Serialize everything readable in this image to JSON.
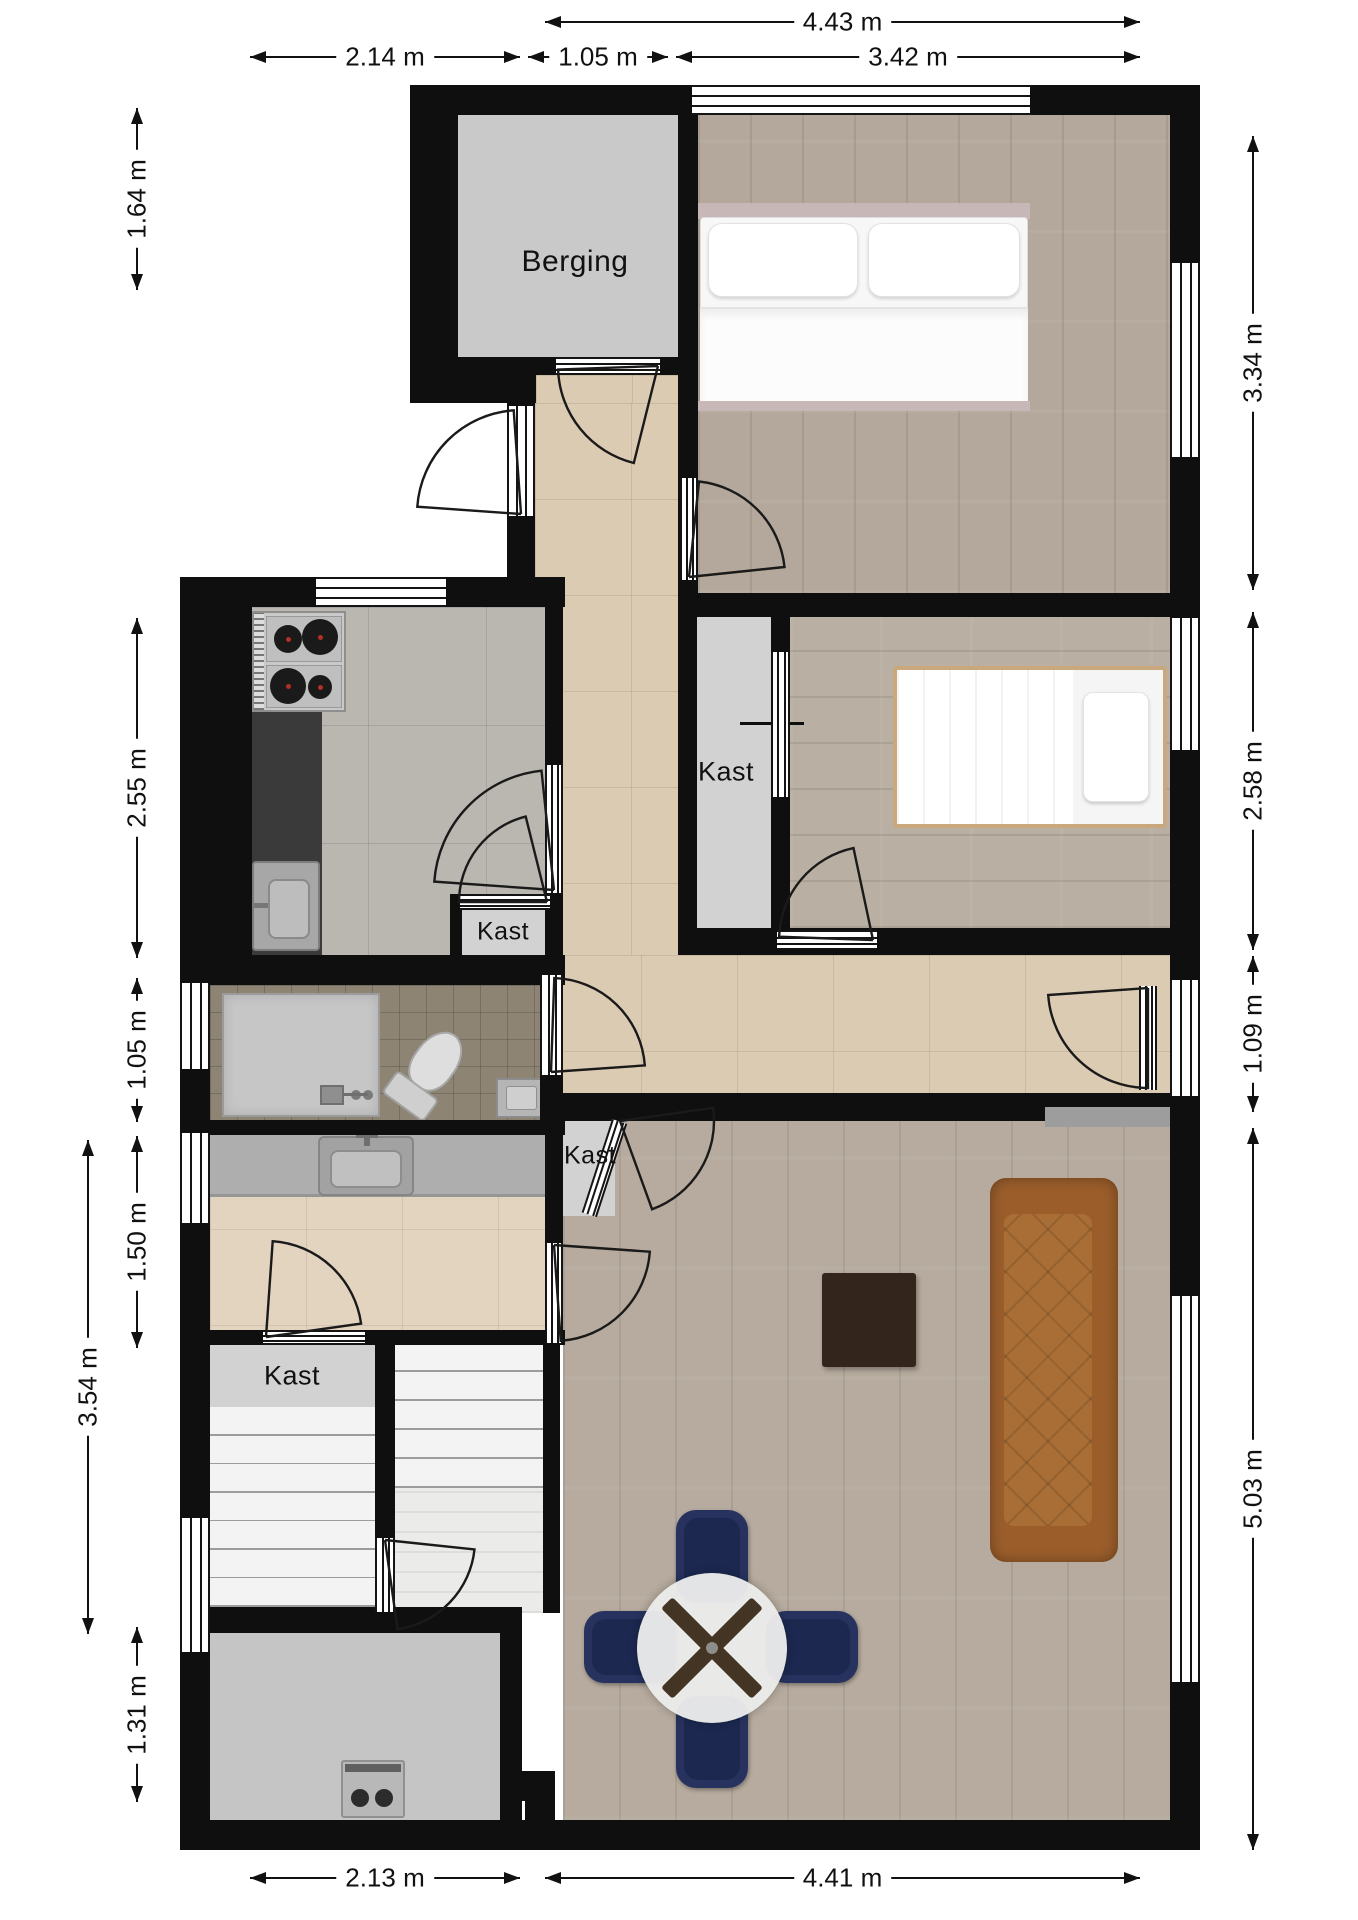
{
  "meta": {
    "type": "floor-plan",
    "language": "nl"
  },
  "colors": {
    "wall": "#0f0f0f",
    "background": "#ffffff",
    "dimension": "#111111",
    "wood_floor": "#b3a89b",
    "hall_tile": "#dccbb3",
    "kitchen_tile": "#bab7b1",
    "toilet_tile": "#8d8474",
    "closet_grey": "#d2d2d2",
    "sofa_leather": "#9b5e2b",
    "chair_navy": "#27335e",
    "coffee_table": "#33251c",
    "counter_dark": "#3a3a3a"
  },
  "room_labels": [
    {
      "text": "Berging",
      "x": 575,
      "y": 262,
      "size": 30
    },
    {
      "text": "Kast",
      "x": 726,
      "y": 772,
      "size": 27
    },
    {
      "text": "Kast",
      "x": 503,
      "y": 932,
      "size": 25
    },
    {
      "text": "Kast",
      "x": 590,
      "y": 1156,
      "size": 25
    },
    {
      "text": "Kast",
      "x": 292,
      "y": 1376,
      "size": 27
    }
  ],
  "dimensions": [
    {
      "label": "4.43 m",
      "dir": "h",
      "a": 545,
      "b": 1140,
      "at": 22
    },
    {
      "label": "2.14 m",
      "dir": "h",
      "a": 250,
      "b": 520,
      "at": 57
    },
    {
      "label": "1.05 m",
      "dir": "h",
      "a": 528,
      "b": 668,
      "at": 57
    },
    {
      "label": "3.42 m",
      "dir": "h",
      "a": 676,
      "b": 1140,
      "at": 57
    },
    {
      "label": "1.64 m",
      "dir": "v",
      "a": 108,
      "b": 290,
      "at": 137
    },
    {
      "label": "2.55 m",
      "dir": "v",
      "a": 618,
      "b": 958,
      "at": 137
    },
    {
      "label": "1.05 m",
      "dir": "v",
      "a": 978,
      "b": 1122,
      "at": 137
    },
    {
      "label": "1.50 m",
      "dir": "v",
      "a": 1136,
      "b": 1348,
      "at": 137
    },
    {
      "label": "3.54 m",
      "dir": "v",
      "a": 1140,
      "b": 1634,
      "at": 88
    },
    {
      "label": "1.31 m",
      "dir": "v",
      "a": 1627,
      "b": 1802,
      "at": 137
    },
    {
      "label": "3.34 m",
      "dir": "v",
      "a": 136,
      "b": 590,
      "at": 1253
    },
    {
      "label": "2.58 m",
      "dir": "v",
      "a": 612,
      "b": 950,
      "at": 1253
    },
    {
      "label": "1.09 m",
      "dir": "v",
      "a": 956,
      "b": 1112,
      "at": 1253
    },
    {
      "label": "5.03 m",
      "dir": "v",
      "a": 1128,
      "b": 1850,
      "at": 1253
    },
    {
      "label": "2.13 m",
      "dir": "h",
      "a": 250,
      "b": 520,
      "at": 1878
    },
    {
      "label": "4.41 m",
      "dir": "h",
      "a": 545,
      "b": 1140,
      "at": 1878
    }
  ],
  "plan": {
    "floors": [
      {
        "name": "berging",
        "r": [
          457,
          115,
          221,
          242
        ],
        "f": "grey"
      },
      {
        "name": "hall-upper",
        "r": [
          536,
          375,
          142,
          28
        ],
        "f": "hall"
      },
      {
        "name": "hall",
        "r": [
          535,
          403,
          143,
          552
        ],
        "f": "hall"
      },
      {
        "name": "bedroom-1",
        "r": [
          698,
          115,
          472,
          478
        ],
        "f": "wood-v"
      },
      {
        "name": "closet-bedroom-2",
        "r": [
          697,
          617,
          74,
          323
        ],
        "f": "grey-light"
      },
      {
        "name": "bedroom-2",
        "r": [
          790,
          617,
          380,
          311
        ],
        "f": "wood-h"
      },
      {
        "name": "kitchen",
        "r": [
          250,
          607,
          295,
          348
        ],
        "f": "kitchen"
      },
      {
        "name": "closet-kitchen",
        "r": [
          462,
          908,
          83,
          47
        ],
        "f": "grey-light"
      },
      {
        "name": "toilet",
        "r": [
          210,
          985,
          330,
          135
        ],
        "f": "toilet"
      },
      {
        "name": "washroom",
        "r": [
          210,
          1133,
          335,
          197
        ],
        "f": "wash"
      },
      {
        "name": "corridor",
        "r": [
          545,
          955,
          625,
          138
        ],
        "f": "hall"
      },
      {
        "name": "living-room",
        "r": [
          563,
          1121,
          607,
          699
        ],
        "f": "wood-l"
      },
      {
        "name": "closet-corridor",
        "r": [
          563,
          1121,
          52,
          95
        ],
        "f": "grey-light"
      },
      {
        "name": "closet-stairs",
        "r": [
          210,
          1343,
          165,
          64
        ],
        "f": "grey-light"
      },
      {
        "name": "stairs-left-base",
        "r": [
          210,
          1407,
          165,
          200
        ],
        "f": "grey-light"
      },
      {
        "name": "stairs-right-base",
        "r": [
          395,
          1343,
          148,
          145
        ],
        "f": "white"
      },
      {
        "name": "stair-landing",
        "r": [
          395,
          1488,
          148,
          125
        ],
        "f": "planks"
      },
      {
        "name": "entrance",
        "r": [
          210,
          1633,
          290,
          187
        ],
        "f": "grey-dark"
      },
      {
        "name": "niche-shelf",
        "r": [
          1045,
          1107,
          125,
          20
        ],
        "f": "grey-mid"
      }
    ],
    "walls": [
      {
        "n": "top",
        "r": [
          410,
          85,
          790,
          30
        ]
      },
      {
        "n": "right",
        "r": [
          1170,
          85,
          30,
          1765
        ]
      },
      {
        "n": "left-top",
        "r": [
          410,
          85,
          48,
          292
        ]
      },
      {
        "n": "facade-step",
        "r": [
          410,
          375,
          126,
          28
        ]
      },
      {
        "n": "hall-west",
        "r": [
          507,
          403,
          28,
          174
        ]
      },
      {
        "n": "kitchen-top",
        "r": [
          180,
          577,
          385,
          30
        ]
      },
      {
        "n": "kitchen-west",
        "r": [
          180,
          577,
          72,
          380
        ]
      },
      {
        "n": "left-lower",
        "r": [
          180,
          955,
          30,
          895
        ]
      },
      {
        "n": "bottom",
        "r": [
          180,
          1820,
          1020,
          30
        ]
      },
      {
        "n": "berging-east",
        "r": [
          678,
          115,
          20,
          262
        ]
      },
      {
        "n": "berging-south",
        "r": [
          457,
          357,
          241,
          18
        ]
      },
      {
        "n": "bed1-west",
        "r": [
          678,
          377,
          20,
          216
        ]
      },
      {
        "n": "bed1-south",
        "r": [
          678,
          593,
          522,
          24
        ]
      },
      {
        "n": "closet2-divider",
        "r": [
          771,
          617,
          19,
          323
        ]
      },
      {
        "n": "corridor-east",
        "r": [
          678,
          617,
          19,
          338
        ]
      },
      {
        "n": "bed2-south",
        "r": [
          678,
          928,
          522,
          27
        ]
      },
      {
        "n": "living-top",
        "r": [
          545,
          1093,
          500,
          28
        ]
      },
      {
        "n": "niche-top",
        "r": [
          1045,
          1093,
          125,
          14
        ]
      },
      {
        "n": "toilet-east",
        "r": [
          540,
          955,
          23,
          180
        ]
      },
      {
        "n": "kitchen-east",
        "r": [
          545,
          577,
          18,
          380
        ]
      },
      {
        "n": "kitchen-south",
        "r": [
          180,
          955,
          385,
          30
        ]
      },
      {
        "n": "toilet-south",
        "r": [
          180,
          1120,
          385,
          15
        ]
      },
      {
        "n": "closet-kitchen-west",
        "r": [
          450,
          894,
          12,
          61
        ]
      },
      {
        "n": "wash-south",
        "r": [
          180,
          1330,
          385,
          15
        ]
      },
      {
        "n": "stairs-divider",
        "r": [
          375,
          1343,
          20,
          290
        ]
      },
      {
        "n": "stairs-south",
        "r": [
          210,
          1607,
          167,
          26
        ]
      },
      {
        "n": "landing-east",
        "r": [
          543,
          1343,
          17,
          270
        ]
      },
      {
        "n": "landing-south",
        "r": [
          375,
          1607,
          147,
          26
        ]
      },
      {
        "n": "entrance-east",
        "r": [
          500,
          1613,
          22,
          207
        ]
      },
      {
        "n": "living-west-upper",
        "r": [
          545,
          1121,
          18,
          122
        ]
      },
      {
        "n": "chimney-a",
        "r": [
          500,
          1771,
          55,
          30
        ]
      },
      {
        "n": "chimney-b",
        "r": [
          525,
          1799,
          30,
          23
        ]
      },
      {
        "n": "window-divider-bed1",
        "r": [
          851,
          87,
          4,
          26
        ]
      },
      {
        "n": "sliding-door-tick",
        "r": [
          740,
          722,
          64,
          3
        ]
      }
    ],
    "windows": [
      {
        "r": [
          692,
          85,
          338,
          30
        ],
        "o": "h"
      },
      {
        "r": [
          316,
          577,
          130,
          30
        ],
        "o": "h"
      },
      {
        "r": [
          180,
          983,
          30,
          86
        ],
        "o": "v"
      },
      {
        "r": [
          180,
          1133,
          30,
          90
        ],
        "o": "v"
      },
      {
        "r": [
          180,
          1518,
          30,
          134
        ],
        "o": "v"
      },
      {
        "r": [
          1170,
          263,
          30,
          194
        ],
        "o": "v"
      },
      {
        "r": [
          1170,
          618,
          30,
          132
        ],
        "o": "v"
      },
      {
        "r": [
          1170,
          980,
          30,
          116
        ],
        "o": "v"
      },
      {
        "r": [
          1170,
          1296,
          30,
          386
        ],
        "o": "v"
      }
    ],
    "doors": [
      {
        "id": "berging-door",
        "panel": [
          556,
          357,
          104,
          18
        ],
        "hinge": [
          658,
          366
        ],
        "r": 100,
        "a1": 178,
        "a2": 104
      },
      {
        "id": "entrance-door",
        "panel": [
          507,
          406,
          28,
          110
        ],
        "hinge": [
          521,
          514
        ],
        "r": 104,
        "a1": 184,
        "a2": 266
      },
      {
        "id": "kitchen-closet-door",
        "panel": [
          460,
          894,
          90,
          16
        ],
        "hinge": [
          547,
          902
        ],
        "r": 88,
        "a1": 180,
        "a2": 256
      },
      {
        "id": "kitchen-door",
        "panel": [
          545,
          765,
          18,
          128
        ],
        "hinge": [
          554,
          890
        ],
        "r": 120,
        "a1": 184,
        "a2": 264
      },
      {
        "id": "bedroom1-door",
        "panel": [
          680,
          478,
          18,
          102
        ],
        "hinge": [
          689,
          577
        ],
        "r": 96,
        "a1": 276,
        "a2": 354
      },
      {
        "id": "bedroom2-door",
        "panel": [
          777,
          930,
          100,
          20
        ],
        "hinge": [
          873,
          940
        ],
        "r": 94,
        "a1": 182,
        "a2": 258
      },
      {
        "id": "toilet-door",
        "panel": [
          540,
          975,
          23,
          100
        ],
        "hinge": [
          551,
          1072
        ],
        "r": 94,
        "a1": 272,
        "a2": 356
      },
      {
        "id": "living-door",
        "panel": [
          1139,
          986,
          18,
          104
        ],
        "hinge": [
          1148,
          988
        ],
        "r": 100,
        "a1": 90,
        "a2": 176
      },
      {
        "id": "corridor-closet-door",
        "panel": [
          612,
          1119,
          16,
          98
        ],
        "rot": 18,
        "hinge": [
          620,
          1121
        ],
        "r": 94,
        "a1": -8,
        "a2": 70
      },
      {
        "id": "washroom-living-door",
        "panel": [
          545,
          1243,
          18,
          100
        ],
        "hinge": [
          554,
          1245
        ],
        "r": 96,
        "a1": 4,
        "a2": 86
      },
      {
        "id": "stairs-landing-door",
        "panel": [
          375,
          1538,
          20,
          74
        ],
        "hinge": [
          385,
          1540
        ],
        "r": 90,
        "a1": 6,
        "a2": 82
      },
      {
        "id": "stairs-closet-door",
        "panel": [
          263,
          1330,
          102,
          15
        ],
        "hinge": [
          266,
          1337
        ],
        "r": 96,
        "a1": 274,
        "a2": 352
      },
      {
        "id": "bedroom2-closet-sliding-door",
        "panel": [
          771,
          652,
          19,
          145
        ],
        "slide": true
      }
    ],
    "furniture": [
      {
        "type": "bed-double",
        "r": [
          698,
          203,
          332,
          208
        ]
      },
      {
        "type": "bed-single",
        "r": [
          893,
          666,
          274,
          162
        ]
      },
      {
        "type": "sofa",
        "r": [
          990,
          1178,
          128,
          384
        ]
      },
      {
        "type": "coffee-table",
        "r": [
          822,
          1273,
          94,
          94
        ]
      },
      {
        "type": "dining-set",
        "r": [
          584,
          1508,
          274,
          280
        ]
      },
      {
        "type": "counter-dark",
        "r": [
          250,
          712,
          72,
          243
        ]
      },
      {
        "type": "stove",
        "r": [
          252,
          611,
          94,
          101
        ]
      },
      {
        "type": "sink-kitchen",
        "r": [
          252,
          861,
          68,
          90
        ]
      },
      {
        "type": "counter-wash",
        "r": [
          210,
          1133,
          335,
          64
        ]
      },
      {
        "type": "sink-wash",
        "r": [
          318,
          1136,
          96,
          60
        ]
      },
      {
        "type": "shower",
        "r": [
          222,
          993,
          158,
          124
        ]
      },
      {
        "type": "toilet",
        "r": [
          398,
          1024,
          60,
          96
        ],
        "rot": 36
      },
      {
        "type": "sink-small",
        "r": [
          496,
          1078,
          49,
          40
        ]
      },
      {
        "type": "boiler",
        "r": [
          341,
          1760,
          64,
          58
        ]
      },
      {
        "type": "stairs",
        "r": [
          210,
          1407,
          165,
          200
        ],
        "n": 7
      },
      {
        "type": "stairs",
        "r": [
          395,
          1343,
          148,
          145
        ],
        "n": 5
      }
    ]
  }
}
